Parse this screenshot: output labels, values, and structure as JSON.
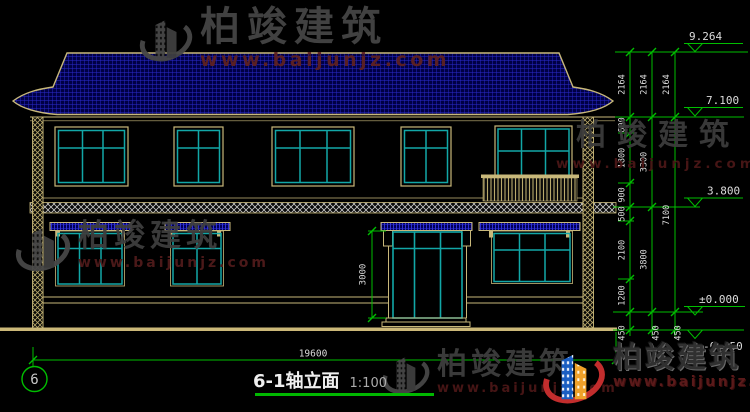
{
  "watermark": {
    "brand": "柏竣建筑",
    "url": "www.baijunjz.com"
  },
  "title": {
    "name": "6-1轴立面",
    "scale": "1:100"
  },
  "axis": {
    "bubble": "6"
  },
  "dimensions": {
    "total_width": "19600",
    "door_height": "3000",
    "chain1": [
      "2164",
      "600",
      "1800",
      "900",
      "500",
      "2100",
      "1200",
      "450"
    ],
    "chain2": [
      "2164",
      "3300",
      "3800",
      "450"
    ],
    "chain3": [
      "2164",
      "7100",
      "450"
    ]
  },
  "levels": [
    "9.264",
    "7.100",
    "3.800",
    "±0.000",
    "-0.450"
  ],
  "colors": {
    "background": "#000000",
    "roof_fill": "#000045",
    "roof_hatch": "#2B2BD0",
    "outline_tan": "#C8B87A",
    "glass_teal": "#12A7A7",
    "dimension_green": "#00BE00",
    "text_white": "#DCDCDC",
    "watermark_gray": "#454545",
    "watermark_red": "#5E2121"
  }
}
